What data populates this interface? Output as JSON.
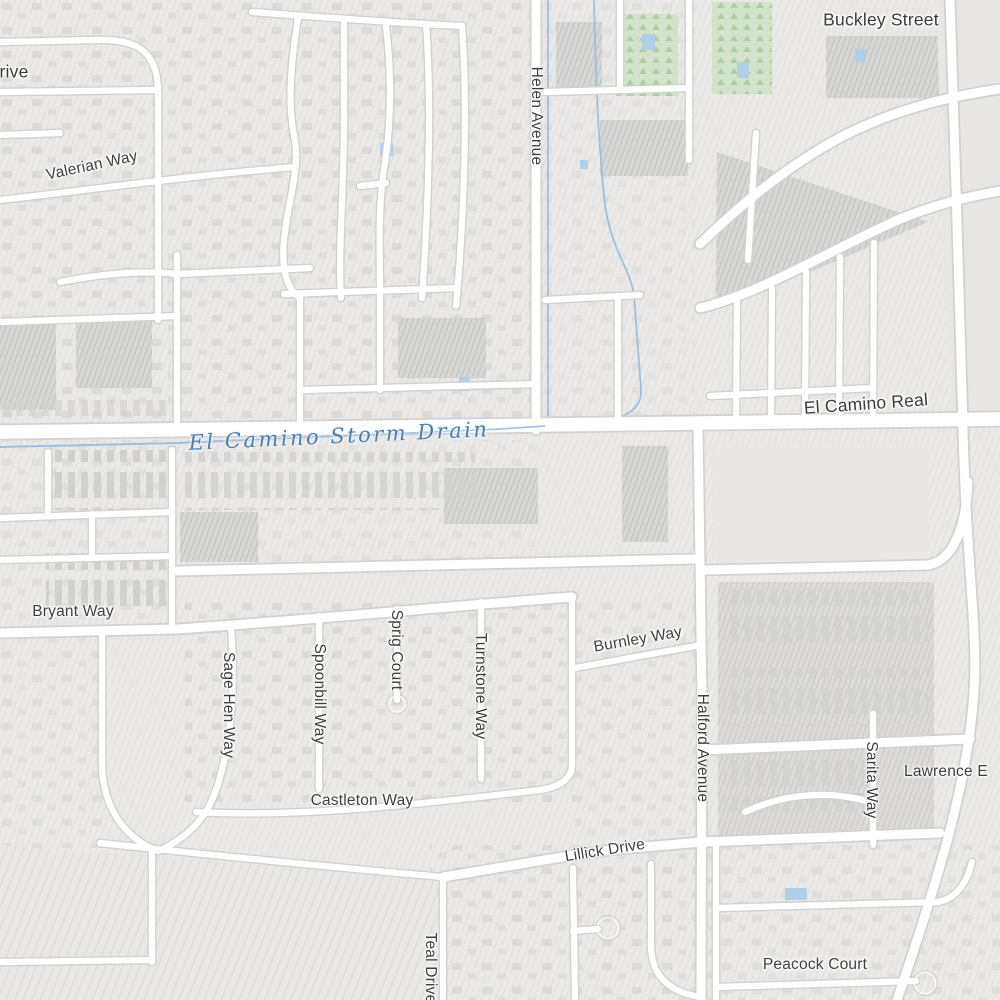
{
  "map": {
    "type": "street-map-tile",
    "colors": {
      "background": "#ebeae8",
      "block_hatch": "#d9d9d7",
      "building": "#d4d4d2",
      "road_fill": "#ffffff",
      "road_casing": "#d2d1cf",
      "water": "#9cbedd",
      "water_label": "#4e7dab",
      "park_green": "#d3e3c9",
      "label_text": "#3f3f3f"
    },
    "labels": {
      "partial_drive": "rive",
      "valerian_way": "Valerian Way",
      "helen_avenue": "Helen Avenue",
      "buckley_street": "Buckley Street",
      "el_camino_real": "El Camino Real",
      "storm_drain": "El Camino Storm Drain",
      "bryant_way": "Bryant Way",
      "burnley_way": "Burnley Way",
      "sage_hen_way": "Sage Hen Way",
      "spoonbill_way": "Spoonbill Way",
      "sprig_court": "Sprig Court",
      "turnstone_way": "Turnstone Way",
      "halford_avenue": "Halford Avenue",
      "sarita_way": "Sarita Way",
      "lawrence_partial": "Lawrence E",
      "castleton_way": "Castleton Way",
      "lillick_drive": "Lillick Drive",
      "teal_drive": "Teal Drive",
      "peacock_court": "Peacock Court"
    }
  }
}
